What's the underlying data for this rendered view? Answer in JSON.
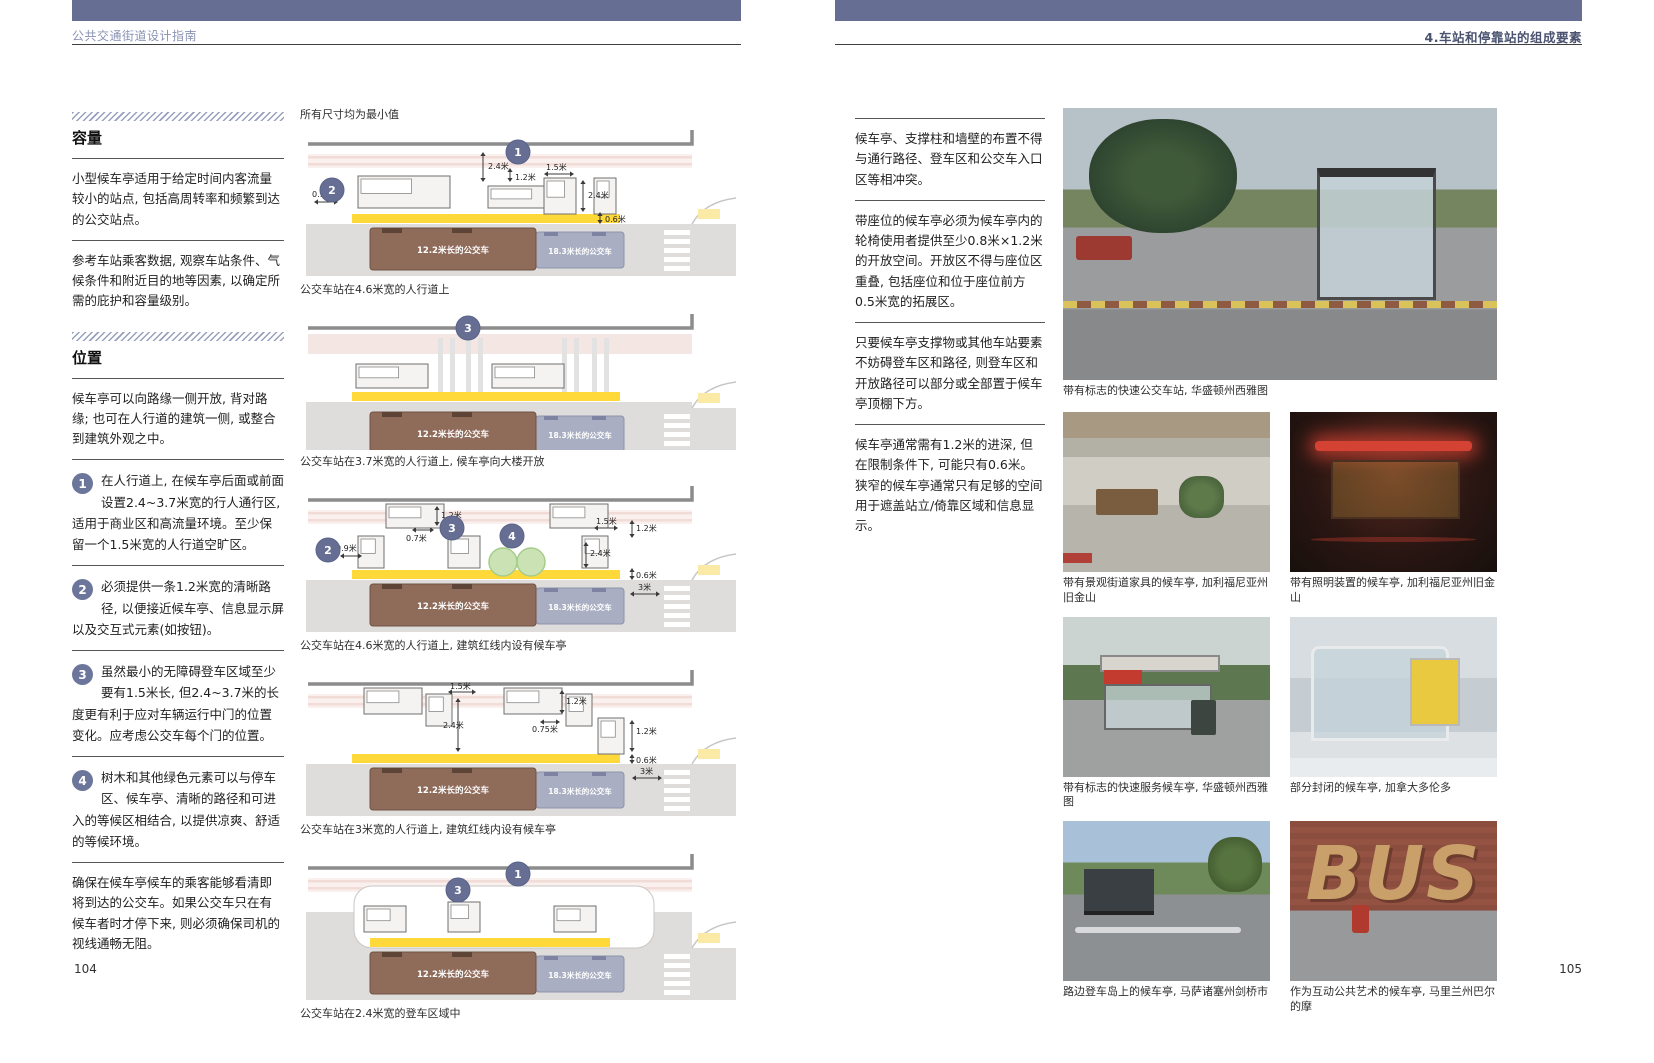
{
  "meta": {
    "accent_color": "#666F93",
    "bus_brown": "#8F6B5A",
    "bus_gray": "#A9AEC2",
    "tactile_yellow": "#FFD83A"
  },
  "page_left": {
    "header": "公共交通街道设计指南",
    "page_number": "104",
    "sections": [
      {
        "title": "容量",
        "paragraphs": [
          "小型候车亭适用于给定时间内客流量较小的站点, 包括高周转率和频繁到达的公交站点。",
          "参考车站乘客数据, 观察车站条件、气候条件和附近目的地等因素, 以确定所需的庇护和容量级别。"
        ]
      },
      {
        "title": "位置",
        "paragraphs": [
          "候车亭可以向路缘一侧开放, 背对路缘; 也可在人行道的建筑一侧, 或整合到建筑外观之中。"
        ]
      }
    ],
    "items": [
      {
        "num": "1",
        "text": "在人行道上, 在候车亭后面或前面设置2.4~3.7米宽的行人通行区, 适用于商业区和高流量环境。至少保留一个1.5米宽的人行道空旷区。"
      },
      {
        "num": "2",
        "text": "必须提供一条1.2米宽的清晰路径, 以便接近候车亭、信息显示屏以及交互式元素(如按钮)。"
      },
      {
        "num": "3",
        "text": "虽然最小的无障碍登车区域至少要有1.5米长, 但2.4~3.7米的长度更有利于应对车辆运行中门的位置变化。应考虑公交车每个门的位置。"
      },
      {
        "num": "4",
        "text": "树木和其他绿色元素可以与停车区、候车亭、清晰的路径和可进入的等候区相结合, 以提供凉爽、舒适的等候环境。"
      }
    ],
    "closing": "确保在候车亭候车的乘客能够看清即将到达的公交车。如果公交车只在有候车者时才停下来, 则必须确保司机的视线通畅无阻。",
    "diagram_note": "所有尺寸均为最小值",
    "bus_labels": {
      "bus_12": "12.2米长的公交车",
      "bus_18": "18.3米长的公交车"
    },
    "diagrams": [
      {
        "caption": "公交车站在4.6米宽的人行道上",
        "markers": [
          "1",
          "2"
        ],
        "dims": [
          "2.4米",
          "1.2米",
          "1.5米",
          "2.4米",
          "0.9米",
          "0.6米"
        ]
      },
      {
        "caption": "公交车站在3.7米宽的人行道上, 候车亭向大楼开放",
        "markers": [
          "3"
        ],
        "dims": []
      },
      {
        "caption": "公交车站在4.6米宽的人行道上, 建筑红线内设有候车亭",
        "markers": [
          "2",
          "3",
          "4"
        ],
        "dims": [
          "1.2米",
          "0.7米",
          "0.9米",
          "1.5米",
          "1.2米",
          "2.4米",
          "0.6米",
          "3米"
        ]
      },
      {
        "caption": "公交车站在3米宽的人行道上, 建筑红线内设有候车亭",
        "markers": [],
        "dims": [
          "1.5米",
          "2.4米",
          "1.2米",
          "0.75米",
          "1.2米",
          "0.6米",
          "3米"
        ]
      },
      {
        "caption": "公交车站在2.4米宽的登车区域中",
        "markers": [
          "1",
          "3"
        ],
        "dims": []
      }
    ]
  },
  "page_right": {
    "header": "4.车站和停靠站的组成要素",
    "page_number": "105",
    "paragraphs": [
      "候车亭、支撑柱和墙壁的布置不得与通行路径、登车区和公交车入口区等相冲突。",
      "带座位的候车亭必须为候车亭内的轮椅使用者提供至少0.8米×1.2米的开放空间。开放区不得与座位区重叠, 包括座位和位于座位前方0.5米宽的拓展区。",
      "只要候车亭支撑物或其他车站要素不妨碍登车区和路径, 则登车区和开放路径可以部分或全部置于候车亭顶棚下方。",
      "候车亭通常需有1.2米的进深, 但在限制条件下, 可能只有0.6米。狭窄的候车亭通常只有足够的空间用于遮盖站立/倚靠区域和信息显示。"
    ],
    "photos": [
      {
        "caption": "带有标志的快速公交车站, 华盛顿州西雅图"
      },
      {
        "caption": "带有景观街道家具的候车亭, 加利福尼亚州旧金山"
      },
      {
        "caption": "带有照明装置的候车亭, 加利福尼亚州旧金山"
      },
      {
        "caption": "带有标志的快速服务候车亭, 华盛顿州西雅图"
      },
      {
        "caption": "部分封闭的候车亭, 加拿大多伦多"
      },
      {
        "caption": "路边登车岛上的候车亭, 马萨诸塞州剑桥市"
      },
      {
        "caption": "作为互动公共艺术的候车亭, 马里兰州巴尔的摩",
        "overlay_text": "BUS"
      }
    ]
  }
}
